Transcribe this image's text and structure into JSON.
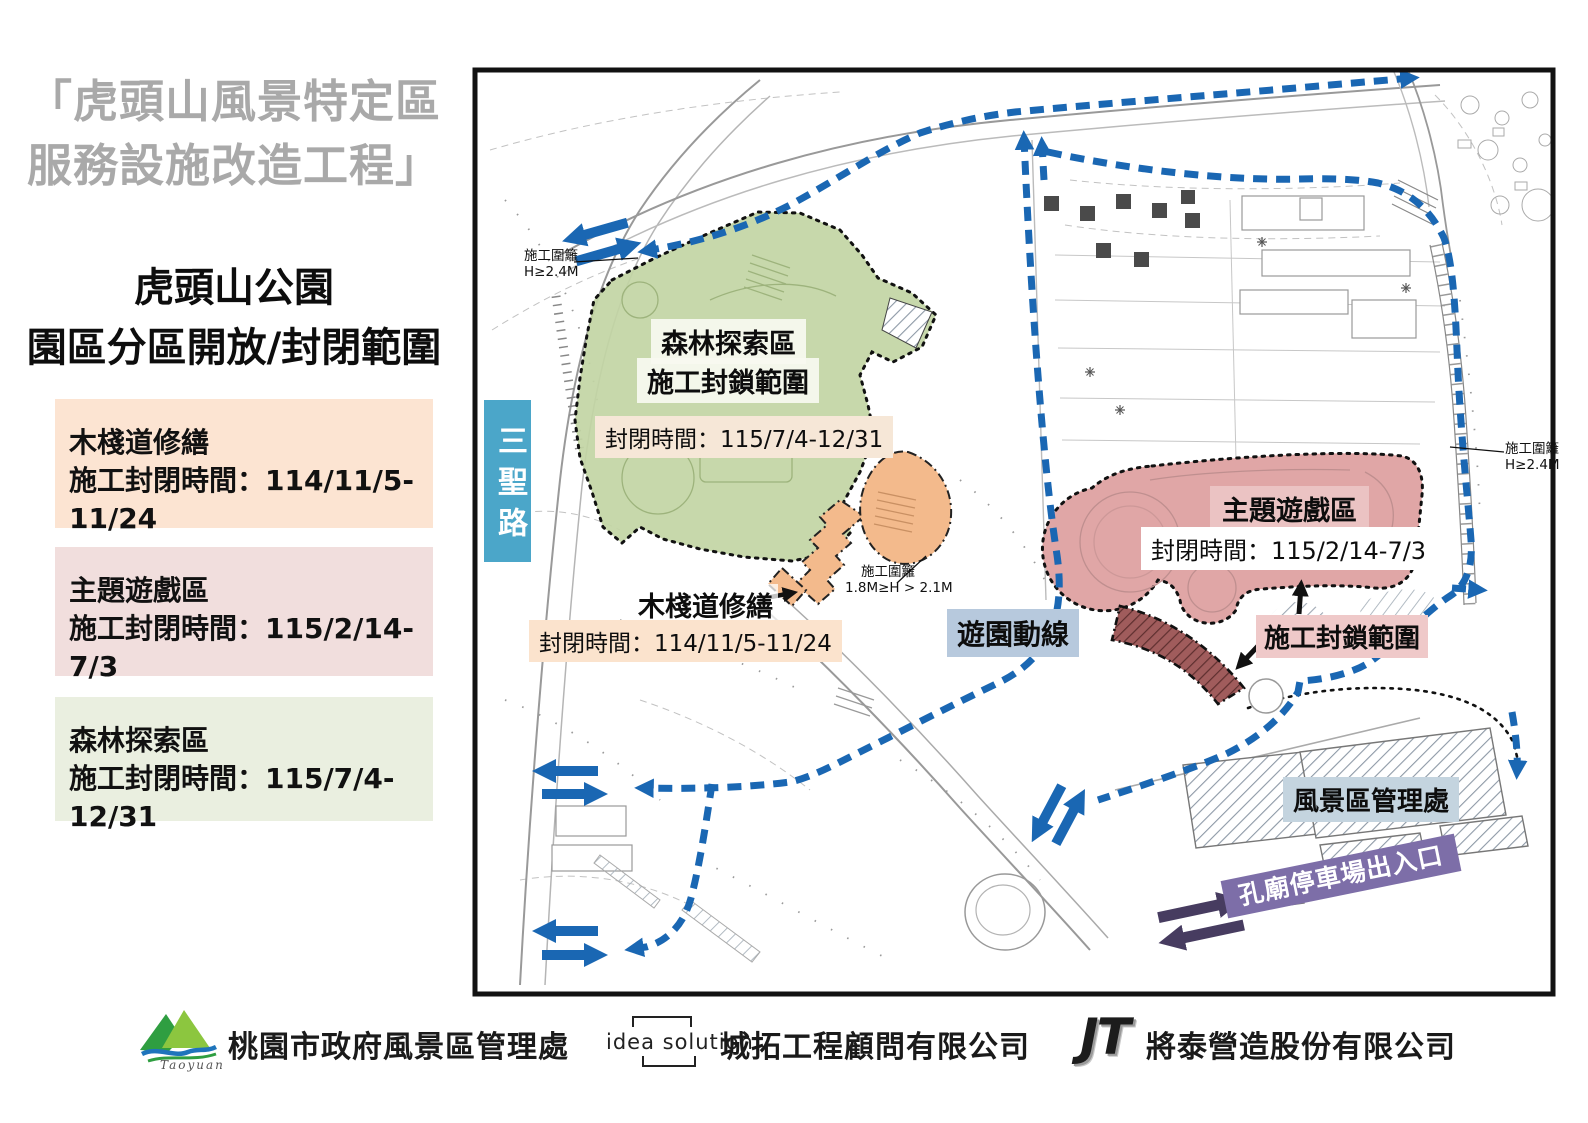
{
  "left_panel": {
    "project_title_line1": "「虎頭山風景特定區",
    "project_title_line2": "服務設施改造工程」",
    "subtitle_line1": "虎頭山公園",
    "subtitle_line2": "園區分區開放/封閉範圍",
    "zones": [
      {
        "name": "木棧道修繕",
        "period": "施工封閉時間：114/11/5-11/24",
        "color": "#FCE4D2"
      },
      {
        "name": "主題遊戲區",
        "period": "施工封閉時間：115/2/14-7/3",
        "color": "#F1DEDD"
      },
      {
        "name": "森林探索區",
        "period": "施工封閉時間：115/7/4-12/31",
        "color": "#EAEFE0"
      }
    ]
  },
  "map": {
    "road_label": "三聖路",
    "forest": {
      "title": "森林探索區",
      "range_label": "施工封鎖範圍",
      "closure": "封閉時間：115/7/4-12/31"
    },
    "walkway": {
      "title": "木棧道修繕",
      "closure": "封閉時間：114/11/5-11/24"
    },
    "theme": {
      "title": "主題遊戲區",
      "closure": "封閉時間：115/2/14-7/3",
      "range_label": "施工封鎖範圍"
    },
    "route_label": "遊園動線",
    "admin_label": "風景區管理處",
    "parking_label": "孔廟停車場出入口",
    "fence_left": {
      "line1": "施工圍籬",
      "line2": "H≥2.4M"
    },
    "fence_right": {
      "line1": "施工圍籬",
      "line2": "H≥2.4M"
    },
    "fence_mid": {
      "line1": "施工圍籬",
      "line2": "1.8M≥H > 2.1M"
    },
    "colors": {
      "route_blue": "#1A67B3",
      "forest_green": "#C2D5A4",
      "theme_pink": "#E0A6A6",
      "walkway_orange": "#F3BA8C",
      "closed_dark_red": "#A05C5C",
      "parking_purple": "#7D6EA8",
      "parking_arrow_purple": "#473C60",
      "road_label_teal": "#4BA6C9",
      "route_label_bg": "#B7C9DD",
      "admin_label_bg": "#C4D4DF"
    }
  },
  "footer": {
    "org1": {
      "logo_text": "Taoyuan",
      "name": "桃園市政府風景區管理處"
    },
    "org2": {
      "logo_text": "idea solution",
      "name": "城拓工程顧問有限公司"
    },
    "org3": {
      "logo_text": "JT",
      "name": "將泰營造股份有限公司"
    }
  }
}
